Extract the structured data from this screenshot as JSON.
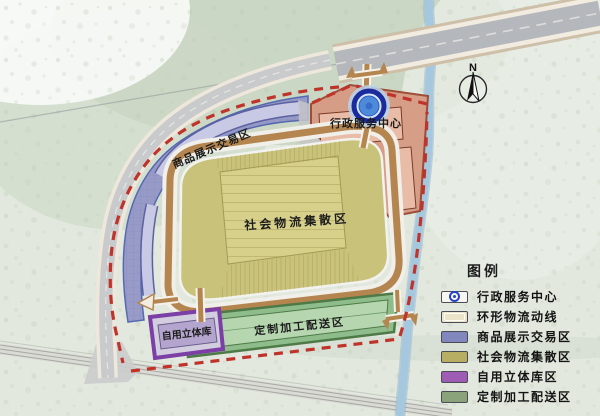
{
  "compass": {
    "north_label": "N"
  },
  "map": {
    "labels": {
      "admin": "行政服务中心",
      "display": "商品展示交易区",
      "logistics": "社会物流集散区",
      "processing": "定制加工配送区",
      "warehouse": "自用立体库"
    },
    "colors": {
      "admin_fill": "#d79a83",
      "admin_border": "#9c4630",
      "display_fill": "#9295c7",
      "logistics_fill": "#c9c27b",
      "processing_fill": "#8fbc8b",
      "warehouse_fill": "#d3cde0",
      "warehouse_border": "#7b3fa5",
      "ring_road": "#b5854f",
      "boundary_dash": "#c0332a",
      "river": "#a6c8df",
      "road": "#b4b7bb"
    }
  },
  "legend": {
    "title": "图例",
    "items": [
      {
        "label": "行政服务中心",
        "color": "#f7f6f2",
        "type": "admin-marker"
      },
      {
        "label": "环形物流动线",
        "color": "#ece3cb",
        "type": "ring-road"
      },
      {
        "label": "商品展示交易区",
        "color": "#8287bd",
        "type": "zone"
      },
      {
        "label": "社会物流集散区",
        "color": "#b7ae63",
        "type": "zone"
      },
      {
        "label": "自用立体库区",
        "color": "#9f5cb4",
        "type": "zone"
      },
      {
        "label": "定制加工配送区",
        "color": "#8ba37a",
        "type": "zone"
      }
    ]
  }
}
